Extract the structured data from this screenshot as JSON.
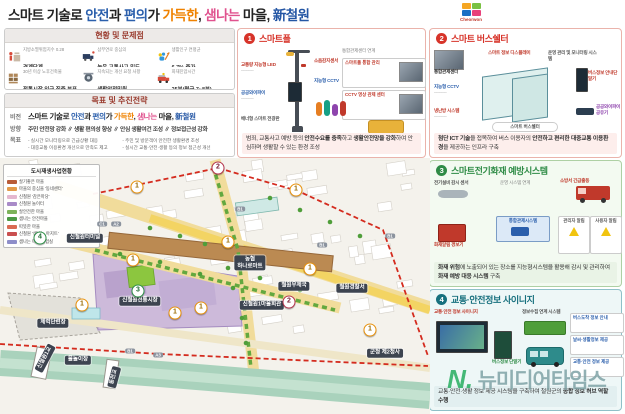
{
  "header": {
    "title_parts": [
      {
        "t": "스마트 기술로 ",
        "c": "#222222"
      },
      {
        "t": "안전",
        "c": "#2b5fac"
      },
      {
        "t": "과 ",
        "c": "#222222"
      },
      {
        "t": "편의",
        "c": "#2b5fac"
      },
      {
        "t": "가 ",
        "c": "#222222"
      },
      {
        "t": "가득한",
        "c": "#ef8200"
      },
      {
        "t": ", ",
        "c": "#222222"
      },
      {
        "t": "샘나는",
        "c": "#e0528e"
      },
      {
        "t": " 마을, ",
        "c": "#222222"
      },
      {
        "t": "新철원",
        "c": "#2456a4"
      }
    ],
    "logo_text": "Cheorwon",
    "logo_colors": [
      "#f5a623",
      "#7ac143",
      "#1a6fc4",
      "#e8417a"
    ]
  },
  "status_panel": {
    "title": "현황 및 문제점",
    "items": [
      {
        "icon": "population",
        "small": "지방소멸위험지수 0.28",
        "bold": "경계단계"
      },
      {
        "icon": "traffic",
        "small": "삼부연로 중심의",
        "bold": "높은 교통사고 밀도"
      },
      {
        "icon": "growth",
        "small": "생활인구 연평균",
        "bold": "6.7% 증가"
      },
      {
        "icon": "market",
        "small": "30년 이상 노후건축물",
        "bold": "전통시장 인근 집중 분포"
      },
      {
        "icon": "cctv",
        "small": "지속되는 개선 요청 사항",
        "bold": "생활안전민원"
      },
      {
        "icon": "firetruck",
        "small": "화재진압시간",
        "bold": "25분(평균 7~8분)"
      }
    ]
  },
  "goal_panel": {
    "title": "목표 및 추진전략",
    "vision_label": "비전",
    "direction_label": "방향",
    "goal_label": "목표",
    "direction": "주민 안전망 강화 ∥ 생활 편의성 향상 ∥ 안심 생활여건 조성 ∥ 정보접근성 강화",
    "goals": [
      "실시간 모니터링으로 긴급상황 대응",
      "주민 및 방문객이 안전한 생활환경 조성",
      "대중교통 이용환경 개선으로 만족도 제고",
      "실시간 교통·안전·생활 등의 정보 접근성 개선"
    ]
  },
  "map": {
    "legend": {
      "title": "도시재생사업현황",
      "rows": [
        {
          "c": "#b85c38",
          "t": "살기좋은 마을"
        },
        {
          "c": "#e39b4a",
          "t": "마을의 중심을 '동네센터'"
        },
        {
          "c": "#e4b7cf",
          "t": "신철원 '감은마당'"
        },
        {
          "c": "#a98bc8",
          "t": "신철원 놀이터"
        },
        {
          "c": "#7db35a",
          "t": "살안전한 마을"
        },
        {
          "c": "#4c9a45",
          "t": "샘나는 안전마을"
        },
        {
          "c": "#d96a52",
          "t": "따뜻한 마을"
        },
        {
          "c": "#c94f4f",
          "t": "신철원 '샘나는 아지트'"
        },
        {
          "c": "#8e8ec9",
          "t": "샘나는 마을 실험실"
        }
      ]
    },
    "labels": [
      {
        "t": "신철원터미널",
        "x": 85,
        "y": 80
      },
      {
        "t": "농협\n하나로마트",
        "x": 250,
        "y": 105
      },
      {
        "t": "신철원전통시장",
        "x": 140,
        "y": 143
      },
      {
        "t": "신철원1마을회관",
        "x": 262,
        "y": 147
      },
      {
        "t": "철원우체국",
        "x": 294,
        "y": 128
      },
      {
        "t": "철원경찰서",
        "x": 352,
        "y": 130
      },
      {
        "t": "군청 제2청사",
        "x": 385,
        "y": 195
      },
      {
        "t": "물놀이장",
        "x": 78,
        "y": 202
      },
      {
        "t": "체력단련장",
        "x": 53,
        "y": 165
      },
      {
        "t": "신철원1교",
        "x": 45,
        "y": 200,
        "rot": -62
      },
      {
        "t": "동천교",
        "x": 114,
        "y": 219,
        "rot": -75
      }
    ],
    "markers": [
      {
        "n": "2",
        "c": "m",
        "x": 218,
        "y": 10
      },
      {
        "n": "1",
        "c": "o",
        "x": 137,
        "y": 29
      },
      {
        "n": "1",
        "c": "o",
        "x": 296,
        "y": 32
      },
      {
        "n": "4",
        "c": "g",
        "x": 40,
        "y": 80
      },
      {
        "n": "1",
        "c": "o",
        "x": 133,
        "y": 102
      },
      {
        "n": "1",
        "c": "o",
        "x": 228,
        "y": 84
      },
      {
        "n": "3",
        "c": "g",
        "x": 138,
        "y": 133
      },
      {
        "n": "1",
        "c": "o",
        "x": 201,
        "y": 150
      },
      {
        "n": "2",
        "c": "m",
        "x": 289,
        "y": 144
      },
      {
        "n": "1",
        "c": "o",
        "x": 310,
        "y": 111
      },
      {
        "n": "1",
        "c": "o",
        "x": 370,
        "y": 172
      },
      {
        "n": "1",
        "c": "o",
        "x": 82,
        "y": 147
      },
      {
        "n": "1",
        "c": "o",
        "x": 175,
        "y": 155
      }
    ],
    "badges": [
      {
        "t": "C1",
        "x": 102,
        "y": 66
      },
      {
        "t": "A2",
        "x": 116,
        "y": 66
      },
      {
        "t": "B1",
        "x": 240,
        "y": 51
      },
      {
        "t": "B1",
        "x": 322,
        "y": 87
      },
      {
        "t": "B1",
        "x": 390,
        "y": 78
      },
      {
        "t": "B1",
        "x": 130,
        "y": 193
      },
      {
        "t": "A3",
        "x": 158,
        "y": 197
      }
    ]
  },
  "panels": [
    {
      "num": "1",
      "title": "스마트폴",
      "caption_parts": [
        {
          "t": "범죄, 교통사고 예방 등의 "
        },
        {
          "t": "안전수요를 충족",
          "b": 1
        },
        {
          "t": "하고 "
        },
        {
          "t": "생활안전망을 강화",
          "b": 1
        },
        {
          "t": "하여 안심하며 생활할 수 있는 환경 조성"
        }
      ],
      "features": {
        "f1": "교통량 지능형 LED",
        "f2": "공공와이파이",
        "f3": "배너형 스마트 전광판",
        "f4": "소음감지센서",
        "f5": "지능형 CCTV",
        "f6": "스마트폴 통합 관리",
        "f7": "CCTV 영상 관제 센터",
        "f8": "통합관제센터 연계"
      }
    },
    {
      "num": "2",
      "title": "스마트 버스쉘터",
      "caption_parts": [
        {
          "t": "첨단 ICT 기술",
          "b": 1
        },
        {
          "t": "을 접목하여 버스 이용자의 "
        },
        {
          "t": "안전하고 편리한 대중교통 이용환경",
          "b": 1
        },
        {
          "t": "을 제공하는 인프라 구축"
        }
      ],
      "features": {
        "f1": "통합관제센터",
        "f2": "지능형 CCTV",
        "f3": "냉난방 시스템",
        "f4": "스마트 정보 디스플레이",
        "f5": "운영 관리 및 모니터링 시스템",
        "f6": "버스정보 안내단말기",
        "f7": "공공와이파이 공유기",
        "f8": "스마트 버스쉘터"
      }
    },
    {
      "num": "3",
      "title": "스마트전기화재 예방시스템",
      "caption_parts": [
        {
          "t": "화재 위험",
          "b": 1
        },
        {
          "t": "에 노출되어 있는 장소를 지능형시스템을 활용해 감시 및 관리하여 "
        },
        {
          "t": "화재 예방 대응 시스템",
          "b": 1
        },
        {
          "t": " 구축"
        }
      ],
      "features": {
        "f1": "전기설비 감시 센서",
        "f2": "화재알림 경보기",
        "f3": "통합관제시스템",
        "f4": "소방서 긴급출동",
        "f5": "관리자 알림",
        "f6": "사용자 알림",
        "f7": "운영 시스템 연계"
      }
    },
    {
      "num": "4",
      "title": "교통·안전정보 사이니지",
      "caption_parts": [
        {
          "t": "교통·안전·생활 정보 제공 시스템을 구축하여 철원군의 "
        },
        {
          "t": "종합 정보 허브 역할 수행",
          "b": 1
        }
      ],
      "features": {
        "f1": "교통·안전 정보 사이니지",
        "f2": "버스정보 단말기",
        "f3": "정보수집 연계 시스템",
        "f4": "버스도착 정보 안내",
        "f5": "날씨·생활정보 제공",
        "f6": "교통·안전 정보 제공"
      }
    }
  ],
  "watermark": {
    "n": "N.",
    "text": "뉴미디어타임스"
  }
}
